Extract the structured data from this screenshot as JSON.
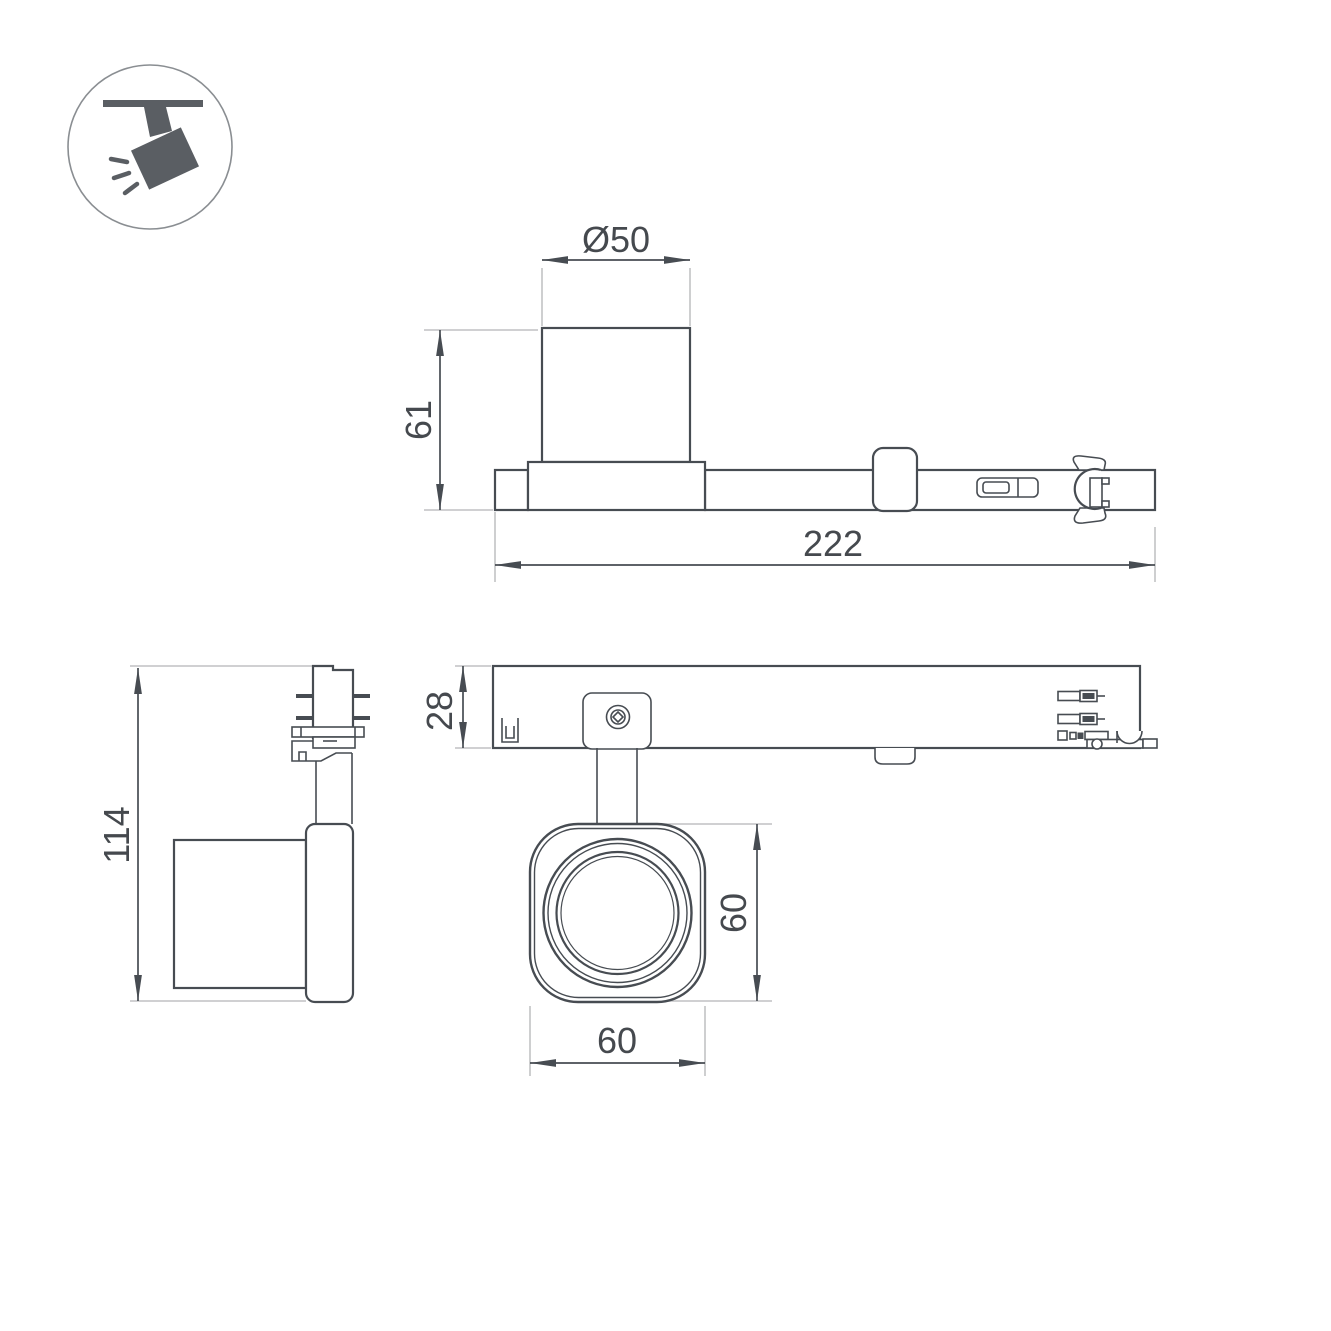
{
  "icon": {
    "name": "track-spotlight-icon"
  },
  "colors": {
    "background": "#ffffff",
    "outline": "#474c52",
    "extension_line": "#b3b5b7",
    "icon_fill": "#5a5e63",
    "text": "#45494e"
  },
  "dimensions": {
    "head_diameter": "Ø50",
    "head_height": "61",
    "total_length": "222",
    "overall_height": "114",
    "track_body_height": "28",
    "head_outer_height": "60",
    "head_outer_width": "60"
  }
}
